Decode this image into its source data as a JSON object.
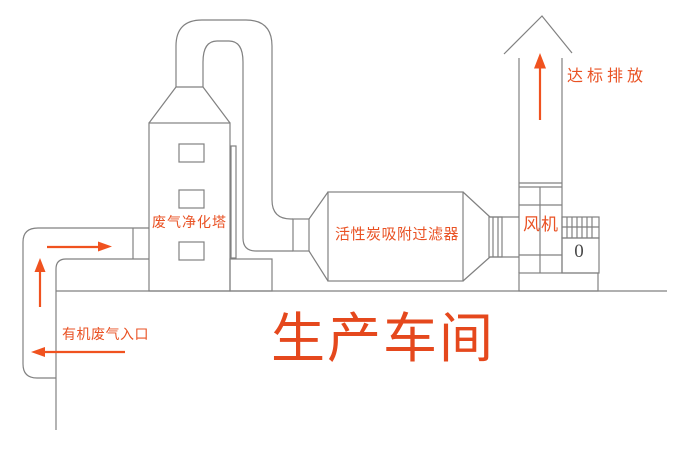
{
  "diagram": {
    "title": "生产车间",
    "labels": {
      "inlet": "有机废气入口",
      "tower": "废气净化塔",
      "filter": "活性炭吸附过滤器",
      "fan": "风机",
      "emission": "达标排放",
      "motor_marking": "0"
    },
    "colors": {
      "background": "#ffffff",
      "line": "#818181",
      "text": "#e95224",
      "arrow": "#f0521f",
      "title": "#e5481d"
    },
    "flow_arrows": [
      {
        "name": "inlet-flow-arrow",
        "direction": "left"
      },
      {
        "name": "riser-flow-arrow",
        "direction": "up"
      },
      {
        "name": "duct-flow-arrow",
        "direction": "right"
      },
      {
        "name": "stack-flow-arrow",
        "direction": "up"
      }
    ]
  }
}
